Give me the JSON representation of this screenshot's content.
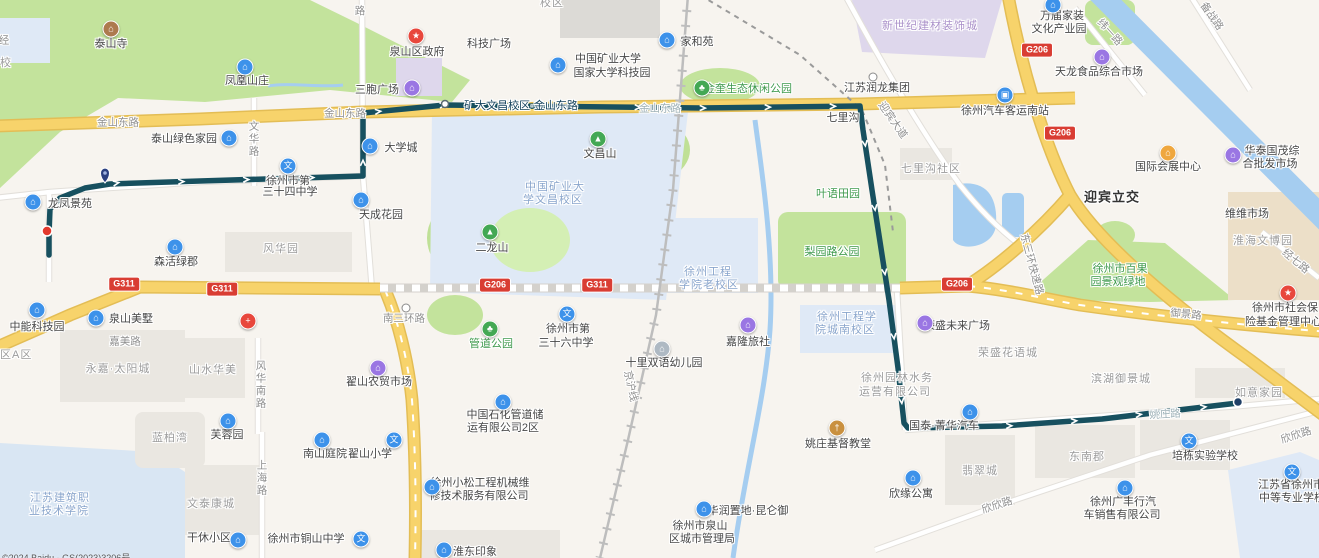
{
  "map": {
    "width": 1319,
    "height": 558,
    "attribution": "©2024 Baidu - GS(2023)3206号"
  },
  "route": {
    "color": "#17505f",
    "points": [
      [
        1238,
        403
      ],
      [
        1102,
        419
      ],
      [
        1002,
        426
      ],
      [
        908,
        428
      ],
      [
        904,
        423
      ],
      [
        898,
        368
      ],
      [
        889,
        300
      ],
      [
        872,
        190
      ],
      [
        863,
        130
      ],
      [
        860,
        106
      ],
      [
        700,
        108
      ],
      [
        520,
        106
      ],
      [
        445,
        105
      ],
      [
        363,
        113
      ],
      [
        363,
        176
      ],
      [
        200,
        181
      ],
      [
        110,
        184
      ],
      [
        85,
        188
      ],
      [
        60,
        198
      ],
      [
        50,
        209
      ],
      [
        49,
        233
      ],
      [
        49,
        255
      ]
    ],
    "stops": [
      {
        "name": "矿大文昌校区·金山东路",
        "x": 445,
        "y": 104
      }
    ],
    "start_pin": {
      "x": 1238,
      "y": 402
    },
    "terminal_dot": {
      "x": 47,
      "y": 231
    },
    "mid_pin": {
      "x": 105,
      "y": 175
    }
  },
  "shields": [
    {
      "label": "G311",
      "x": 124,
      "y": 284
    },
    {
      "label": "G311",
      "x": 222,
      "y": 289
    },
    {
      "label": "G206",
      "x": 495,
      "y": 285
    },
    {
      "label": "G311",
      "x": 597,
      "y": 285
    },
    {
      "label": "G206",
      "x": 957,
      "y": 284
    },
    {
      "label": "G206",
      "x": 1037,
      "y": 50
    },
    {
      "label": "G206",
      "x": 1060,
      "y": 133
    }
  ],
  "labels": [
    {
      "t": "泰山寺",
      "x": 111,
      "y": 43,
      "c": "poi"
    },
    {
      "t": "凤凰山庄",
      "x": 247,
      "y": 80,
      "c": "poi"
    },
    {
      "t": "泉山区政府",
      "x": 417,
      "y": 51,
      "c": "poi"
    },
    {
      "t": "三胞广场",
      "x": 377,
      "y": 89,
      "c": "poi"
    },
    {
      "t": "科技广场",
      "x": 489,
      "y": 43,
      "c": "poi"
    },
    {
      "t": "中国矿业大学",
      "x": 608,
      "y": 58,
      "c": "poi"
    },
    {
      "t": "国家大学科技园",
      "x": 612,
      "y": 72,
      "c": "poi"
    },
    {
      "t": "家和苑",
      "x": 697,
      "y": 41,
      "c": "poi"
    },
    {
      "t": "金奎生态休闲公园",
      "x": 748,
      "y": 88,
      "c": "green"
    },
    {
      "t": "江苏润龙集团",
      "x": 877,
      "y": 87,
      "c": "poi"
    },
    {
      "t": "七里沟",
      "x": 843,
      "y": 117,
      "c": "poi"
    },
    {
      "t": "七里沟社区",
      "x": 931,
      "y": 168,
      "c": "area"
    },
    {
      "t": "徐州汽车客运南站",
      "x": 1005,
      "y": 110,
      "c": "poi"
    },
    {
      "t": "万届家装",
      "x": 1062,
      "y": 15,
      "c": "poi"
    },
    {
      "t": "文化产业园",
      "x": 1059,
      "y": 28,
      "c": "poi"
    },
    {
      "t": "新世纪建材装饰城",
      "x": 930,
      "y": 25,
      "c": "mall"
    },
    {
      "t": "天龙食品综合市场",
      "x": 1099,
      "y": 71,
      "c": "poi"
    },
    {
      "t": "国际会展中心",
      "x": 1168,
      "y": 166,
      "c": "poi"
    },
    {
      "t": "华泰国茂综",
      "x": 1272,
      "y": 150,
      "c": "poi"
    },
    {
      "t": "合批发市场",
      "x": 1270,
      "y": 163,
      "c": "poi"
    },
    {
      "t": "维维市场",
      "x": 1247,
      "y": 213,
      "c": "poi"
    },
    {
      "t": "淮海文博园",
      "x": 1263,
      "y": 240,
      "c": "area"
    },
    {
      "t": "徐州市社会保",
      "x": 1252,
      "y": 307,
      "c": "poi left"
    },
    {
      "t": "险基金管理中心",
      "x": 1245,
      "y": 321,
      "c": "poi left"
    },
    {
      "t": "迎宾立交",
      "x": 1112,
      "y": 196,
      "c": "bold"
    },
    {
      "t": "迎宾大道",
      "x": 893,
      "y": 120,
      "c": "road",
      "r": 55
    },
    {
      "t": "纬一路",
      "x": 1110,
      "y": 32,
      "c": "road",
      "r": 48
    },
    {
      "t": "备战路",
      "x": 1212,
      "y": 16,
      "c": "road",
      "r": 55
    },
    {
      "t": "经七路",
      "x": 1296,
      "y": 261,
      "c": "road",
      "r": 40
    },
    {
      "t": "东三环快速路",
      "x": 1032,
      "y": 264,
      "c": "road",
      "r": 75
    },
    {
      "t": "御景路",
      "x": 1186,
      "y": 314,
      "c": "road",
      "r": 6
    },
    {
      "t": "金山东路",
      "x": 118,
      "y": 122,
      "c": "road"
    },
    {
      "t": "金山东路",
      "x": 345,
      "y": 113,
      "c": "road"
    },
    {
      "t": "金山东路",
      "x": 660,
      "y": 108,
      "c": "roadfade"
    },
    {
      "t": "矿大文昌校区·金山东路",
      "x": 521,
      "y": 105,
      "c": "stop"
    },
    {
      "t": "文华路",
      "x": 254,
      "y": 139,
      "c": "road vert"
    },
    {
      "t": "路",
      "x": 360,
      "y": 11,
      "c": "road vert"
    },
    {
      "t": "校区",
      "x": 552,
      "y": 2,
      "c": "area"
    },
    {
      "t": "经",
      "x": 4,
      "y": 40,
      "c": "road"
    },
    {
      "t": "校",
      "x": 6,
      "y": 62,
      "c": "area"
    },
    {
      "t": "泰山绿色家园",
      "x": 184,
      "y": 138,
      "c": "poi"
    },
    {
      "t": "大学城",
      "x": 401,
      "y": 147,
      "c": "poi"
    },
    {
      "t": "天成花园",
      "x": 381,
      "y": 214,
      "c": "poi"
    },
    {
      "t": "徐州市第",
      "x": 288,
      "y": 180,
      "c": "poi"
    },
    {
      "t": "三十四中学",
      "x": 290,
      "y": 191,
      "c": "poi"
    },
    {
      "t": "龙凤景苑",
      "x": 70,
      "y": 203,
      "c": "poi"
    },
    {
      "t": "森活绿郡",
      "x": 176,
      "y": 261,
      "c": "poi"
    },
    {
      "t": "风华园",
      "x": 281,
      "y": 248,
      "c": "area"
    },
    {
      "t": "文昌山",
      "x": 600,
      "y": 153,
      "c": "poi"
    },
    {
      "t": "二龙山",
      "x": 492,
      "y": 247,
      "c": "poi"
    },
    {
      "t": "中国矿业大",
      "x": 555,
      "y": 186,
      "c": "campus"
    },
    {
      "t": "学文昌校区",
      "x": 553,
      "y": 199,
      "c": "campus"
    },
    {
      "t": "徐州工程",
      "x": 708,
      "y": 271,
      "c": "campus"
    },
    {
      "t": "学院老校区",
      "x": 709,
      "y": 284,
      "c": "campus"
    },
    {
      "t": "徐州工程学",
      "x": 847,
      "y": 316,
      "c": "campus"
    },
    {
      "t": "院城南校区",
      "x": 845,
      "y": 329,
      "c": "campus"
    },
    {
      "t": "叶语田园",
      "x": 838,
      "y": 193,
      "c": "green"
    },
    {
      "t": "梨园路公园",
      "x": 832,
      "y": 251,
      "c": "green"
    },
    {
      "t": "徐州市百果",
      "x": 1120,
      "y": 268,
      "c": "green"
    },
    {
      "t": "园景观绿地",
      "x": 1118,
      "y": 281,
      "c": "green"
    },
    {
      "t": "荣盛未来广场",
      "x": 957,
      "y": 325,
      "c": "poi"
    },
    {
      "t": "荣盛花语城",
      "x": 1008,
      "y": 352,
      "c": "area"
    },
    {
      "t": "滨湖御景城",
      "x": 1121,
      "y": 378,
      "c": "area"
    },
    {
      "t": "徐州园林水务",
      "x": 897,
      "y": 377,
      "c": "area"
    },
    {
      "t": "运营有限公司",
      "x": 895,
      "y": 391,
      "c": "area"
    },
    {
      "t": "中能科技园",
      "x": 37,
      "y": 326,
      "c": "poi"
    },
    {
      "t": "泉山美墅",
      "x": 131,
      "y": 318,
      "c": "poi"
    },
    {
      "t": "嘉美路",
      "x": 125,
      "y": 341,
      "c": "road"
    },
    {
      "t": "区A区",
      "x": 0,
      "y": 354,
      "c": "area left"
    },
    {
      "t": "永嘉·太阳城",
      "x": 118,
      "y": 368,
      "c": "area"
    },
    {
      "t": "山水华美",
      "x": 213,
      "y": 369,
      "c": "area"
    },
    {
      "t": "风华南路",
      "x": 261,
      "y": 385,
      "c": "road vert"
    },
    {
      "t": "南三环路",
      "x": 404,
      "y": 318,
      "c": "road"
    },
    {
      "t": "翟山农贸市场",
      "x": 379,
      "y": 381,
      "c": "poi"
    },
    {
      "t": "管道公园",
      "x": 491,
      "y": 343,
      "c": "green"
    },
    {
      "t": "徐州市第",
      "x": 568,
      "y": 328,
      "c": "poi"
    },
    {
      "t": "三十六中学",
      "x": 566,
      "y": 342,
      "c": "poi"
    },
    {
      "t": "十里双语幼儿园",
      "x": 664,
      "y": 362,
      "c": "poi"
    },
    {
      "t": "嘉隆旅社",
      "x": 748,
      "y": 341,
      "c": "poi"
    },
    {
      "t": "京沪线",
      "x": 631,
      "y": 386,
      "c": "road",
      "r": 78
    },
    {
      "t": "中国石化管道储",
      "x": 505,
      "y": 414,
      "c": "poi"
    },
    {
      "t": "运有限公司2区",
      "x": 503,
      "y": 427,
      "c": "poi"
    },
    {
      "t": "蓝柏湾",
      "x": 170,
      "y": 437,
      "c": "area"
    },
    {
      "t": "芙蓉园",
      "x": 227,
      "y": 434,
      "c": "poi"
    },
    {
      "t": "南山庭院",
      "x": 325,
      "y": 453,
      "c": "poi"
    },
    {
      "t": "翟山小学",
      "x": 370,
      "y": 453,
      "c": "poi"
    },
    {
      "t": "江苏建筑职",
      "x": 60,
      "y": 497,
      "c": "campus"
    },
    {
      "t": "业技术学院",
      "x": 59,
      "y": 510,
      "c": "campus"
    },
    {
      "t": "文泰康城",
      "x": 211,
      "y": 503,
      "c": "area"
    },
    {
      "t": "上海路",
      "x": 262,
      "y": 478,
      "c": "road vert"
    },
    {
      "t": "干休小区",
      "x": 209,
      "y": 537,
      "c": "poi"
    },
    {
      "t": "徐州市铜山中学",
      "x": 306,
      "y": 538,
      "c": "poi"
    },
    {
      "t": "徐州小松工程机械维",
      "x": 480,
      "y": 482,
      "c": "poi"
    },
    {
      "t": "修技术服务有限公司",
      "x": 479,
      "y": 495,
      "c": "poi"
    },
    {
      "t": "淮东印象",
      "x": 475,
      "y": 551,
      "c": "poi"
    },
    {
      "t": "华润置地·昆仑御",
      "x": 748,
      "y": 510,
      "c": "poi"
    },
    {
      "t": "徐州市泉山",
      "x": 700,
      "y": 525,
      "c": "poi"
    },
    {
      "t": "区城市管理局",
      "x": 702,
      "y": 538,
      "c": "poi"
    },
    {
      "t": "姚庄基督教堂",
      "x": 838,
      "y": 443,
      "c": "poi"
    },
    {
      "t": "国泰·菁华汽车",
      "x": 944,
      "y": 425,
      "c": "poi"
    },
    {
      "t": "姚庄路",
      "x": 1165,
      "y": 414,
      "c": "roadfade",
      "r": -3
    },
    {
      "t": "翡翠城",
      "x": 980,
      "y": 470,
      "c": "area"
    },
    {
      "t": "东南郡",
      "x": 1087,
      "y": 456,
      "c": "area"
    },
    {
      "t": "欣缘公寓",
      "x": 911,
      "y": 493,
      "c": "poi"
    },
    {
      "t": "欣欣路",
      "x": 997,
      "y": 505,
      "c": "road",
      "r": -18
    },
    {
      "t": "欣欣路",
      "x": 1296,
      "y": 435,
      "c": "road",
      "r": -18
    },
    {
      "t": "徐州广丰行汽",
      "x": 1123,
      "y": 501,
      "c": "poi"
    },
    {
      "t": "车销售有限公司",
      "x": 1122,
      "y": 514,
      "c": "poi"
    },
    {
      "t": "培栋实验学校",
      "x": 1205,
      "y": 455,
      "c": "poi"
    },
    {
      "t": "如意家园",
      "x": 1259,
      "y": 392,
      "c": "area"
    },
    {
      "t": "江苏省徐州市",
      "x": 1258,
      "y": 484,
      "c": "poi left"
    },
    {
      "t": "中等专业学校",
      "x": 1259,
      "y": 497,
      "c": "poi left"
    }
  ],
  "pois": [
    {
      "t": "temple",
      "x": 111,
      "y": 29
    },
    {
      "t": "blue",
      "x": 245,
      "y": 67
    },
    {
      "t": "gov",
      "x": 416,
      "y": 36
    },
    {
      "t": "purple",
      "x": 412,
      "y": 88
    },
    {
      "t": "blue",
      "x": 558,
      "y": 65
    },
    {
      "t": "blue",
      "x": 667,
      "y": 40
    },
    {
      "t": "park",
      "x": 702,
      "y": 88
    },
    {
      "t": "dot",
      "x": 873,
      "y": 77
    },
    {
      "t": "bus",
      "x": 1005,
      "y": 95
    },
    {
      "t": "blue",
      "x": 1053,
      "y": 5
    },
    {
      "t": "purple",
      "x": 1102,
      "y": 57
    },
    {
      "t": "expo",
      "x": 1168,
      "y": 153
    },
    {
      "t": "purple",
      "x": 1233,
      "y": 155
    },
    {
      "t": "gov",
      "x": 1288,
      "y": 293
    },
    {
      "t": "blue",
      "x": 229,
      "y": 138
    },
    {
      "t": "blue",
      "x": 370,
      "y": 146
    },
    {
      "t": "blue",
      "x": 361,
      "y": 200
    },
    {
      "t": "edu",
      "x": 288,
      "y": 166
    },
    {
      "t": "blue",
      "x": 33,
      "y": 202
    },
    {
      "t": "blue",
      "x": 175,
      "y": 247
    },
    {
      "t": "blue",
      "x": 37,
      "y": 310
    },
    {
      "t": "blue",
      "x": 96,
      "y": 318
    },
    {
      "t": "hosp",
      "x": 248,
      "y": 321
    },
    {
      "t": "purple",
      "x": 378,
      "y": 368
    },
    {
      "t": "edu",
      "x": 567,
      "y": 314
    },
    {
      "t": "kind",
      "x": 662,
      "y": 349
    },
    {
      "t": "purple",
      "x": 748,
      "y": 325
    },
    {
      "t": "blue",
      "x": 503,
      "y": 402
    },
    {
      "t": "edu",
      "x": 394,
      "y": 440
    },
    {
      "t": "blue",
      "x": 322,
      "y": 440
    },
    {
      "t": "blue",
      "x": 228,
      "y": 421
    },
    {
      "t": "blue",
      "x": 238,
      "y": 540
    },
    {
      "t": "edu",
      "x": 361,
      "y": 539
    },
    {
      "t": "blue",
      "x": 432,
      "y": 487
    },
    {
      "t": "blue",
      "x": 704,
      "y": 509
    },
    {
      "t": "church",
      "x": 837,
      "y": 428
    },
    {
      "t": "blue",
      "x": 970,
      "y": 412
    },
    {
      "t": "purple",
      "x": 925,
      "y": 323
    },
    {
      "t": "blue",
      "x": 913,
      "y": 478
    },
    {
      "t": "blue",
      "x": 1125,
      "y": 488
    },
    {
      "t": "edu",
      "x": 1189,
      "y": 441
    },
    {
      "t": "blue",
      "x": 444,
      "y": 550
    },
    {
      "t": "mtn",
      "x": 598,
      "y": 139
    },
    {
      "t": "mtn",
      "x": 490,
      "y": 232
    },
    {
      "t": "park",
      "x": 490,
      "y": 329
    },
    {
      "t": "edu",
      "x": 1292,
      "y": 472
    },
    {
      "t": "dot",
      "x": 406,
      "y": 308
    }
  ]
}
